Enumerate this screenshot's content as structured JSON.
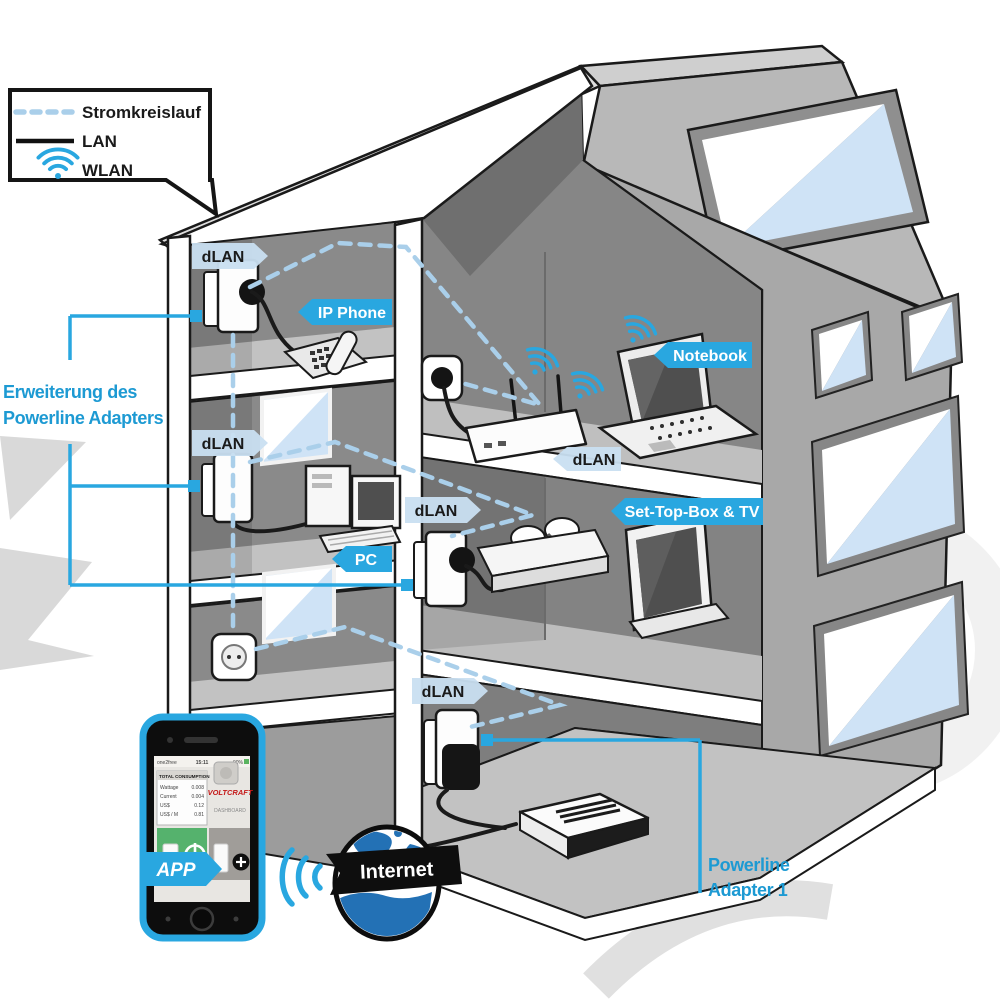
{
  "legend": {
    "items": [
      {
        "id": "stromkreislauf",
        "label": "Stromkreislauf",
        "style": "dashed-line"
      },
      {
        "id": "lan",
        "label": "LAN",
        "style": "solid-line"
      },
      {
        "id": "wlan",
        "label": "WLAN",
        "style": "wifi-icon"
      }
    ]
  },
  "labels": {
    "dlan_floor1": "dLAN",
    "ip_phone": "IP Phone",
    "notebook": "Notebook",
    "dlan_router": "dLAN",
    "dlan_floor2_left": "dLAN",
    "dlan_floor2_right": "dLAN",
    "pc": "PC",
    "settop_tv": "Set-Top-Box & TV",
    "dlan_ground": "dLAN",
    "app": "APP",
    "internet": "Internet"
  },
  "callouts": {
    "extension": {
      "line1": "Erweiterung des",
      "line2": "Powerline Adapters"
    },
    "adapter1": {
      "line1": "Powerline",
      "line2": "Adapter 1"
    }
  },
  "phone_app": {
    "status": {
      "carrier": "one2free",
      "time": "15:11",
      "battery": "90%"
    },
    "table_title": "TOTAL CONSUMPTION",
    "rows": [
      {
        "label": "Wattage",
        "value": "0.008"
      },
      {
        "label": "Current",
        "value": "0.004"
      },
      {
        "label": "US$",
        "value": "0.12"
      },
      {
        "label": "US$ / M",
        "value": "0.81"
      }
    ],
    "brand": "VOLTCRAFT",
    "screen_name": "DASHBOARD"
  },
  "colors": {
    "accent": "#29a7e0",
    "dashed_circuit": "#aacfea",
    "tag_light_blue": "#c9dff1",
    "callout_text_blue": "#1d9ad3",
    "lan_line": "#1a1a1a",
    "brand_red": "#c41818"
  }
}
